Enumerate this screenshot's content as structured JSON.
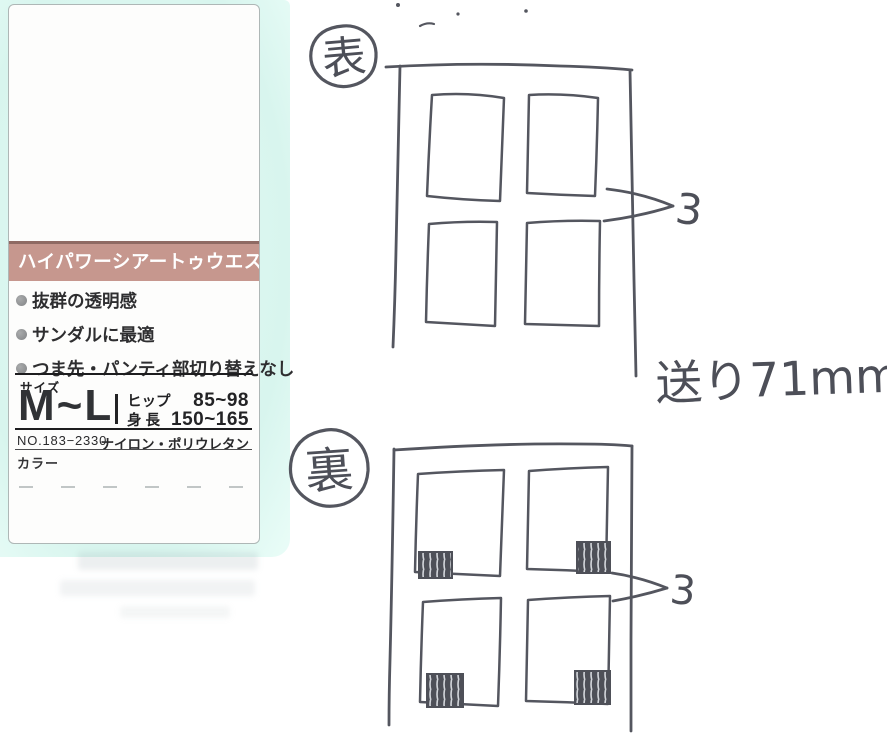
{
  "card": {
    "mat_color": "#d8f5ee",
    "banner": {
      "text": "ハイパワーシアートゥウエスト",
      "bg": "#c6978e"
    },
    "features": [
      "抜群の透明感",
      "サンダルに最適",
      "つま先・パンティ部切り替えなし"
    ],
    "size": {
      "label": "サイズ",
      "value": "M~L",
      "hip_label": "ヒップ",
      "hip_value": "85~98",
      "height_label": "身 長",
      "height_value": "150~165"
    },
    "product_no": "NO.183−2330",
    "material": "ナイロン・ポリウレタン",
    "color_label": "カラー"
  },
  "sketch": {
    "ink_color": "#54565f",
    "front_badge": "表",
    "back_badge": "裏",
    "front_callout_value": "3",
    "back_callout_value": "3",
    "feed_note": "送り71mm"
  }
}
